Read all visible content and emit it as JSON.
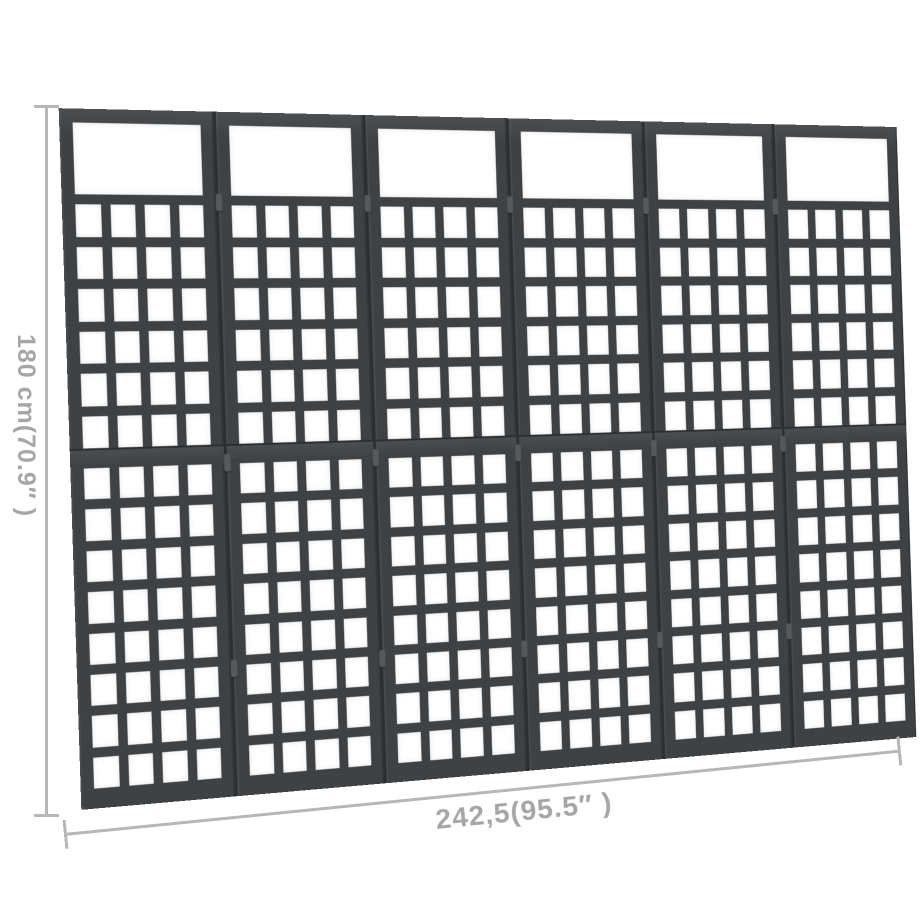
{
  "page": {
    "background": "#ffffff"
  },
  "figure": {
    "type": "product-dimension-diagram",
    "subject": "6-panel wooden trellis room divider, black"
  },
  "dimensions": {
    "height_label": "180 cm(70.9″ )",
    "width_label": "242,5(95.5″ )"
  },
  "product": {
    "panel_count": 6,
    "grid_columns": 4,
    "upper_grid_rows": 6,
    "lower_grid_rows": 8,
    "has_top_opening": true,
    "hinge_positions": [
      0.12,
      0.5,
      0.8
    ]
  },
  "colors": {
    "wood": "#3f4245",
    "wood_light": "#4b4e51",
    "wood_dark": "#2c2f31",
    "hole": "#ffffff",
    "dim_line": "#b7b7b7",
    "dim_label": "#a6a6a6"
  }
}
